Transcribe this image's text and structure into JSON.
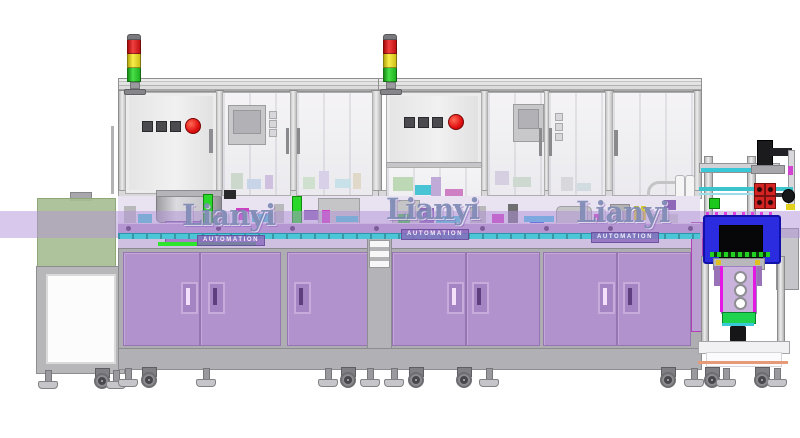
{
  "scene": {
    "type": "cad-render",
    "description": "Automated assembly line, front elevation render on white background",
    "background": "#ffffff"
  },
  "watermark": {
    "brand": "Lianyi",
    "subtitle": "AUTOMATION",
    "text_color": "#7884b0",
    "banner_color": "#8a6abc",
    "instances": 3
  },
  "palette": {
    "cabinet_purple": "#b292cc",
    "band_purple_overlay": "rgba(177,146,215,0.5)",
    "fascia_purple": "#b596d3",
    "frame_gray": "#c9c8cb",
    "glass_gray": "#f2f1f3",
    "signal_red": "#e21212",
    "signal_yellow": "#f2e324",
    "signal_green": "#2fd12f",
    "estop_red": "#e01010",
    "infeed_hood_green": "#a7bd92",
    "process_unit_blue": "#2b2be0",
    "rail_cyan": "#49c6d6",
    "conveyor_green": "#2ce52c"
  },
  "equipment": {
    "signal_towers": 2,
    "enclosure_modules": 2,
    "cabinet_door_handles": 7,
    "control_panels": [
      {
        "square_buttons": 3,
        "emergency_stop_buttons": 1
      },
      {
        "square_buttons": 3,
        "emergency_stop_buttons": 1
      }
    ],
    "bowl_feeders": 1,
    "right_end_station": 1
  }
}
